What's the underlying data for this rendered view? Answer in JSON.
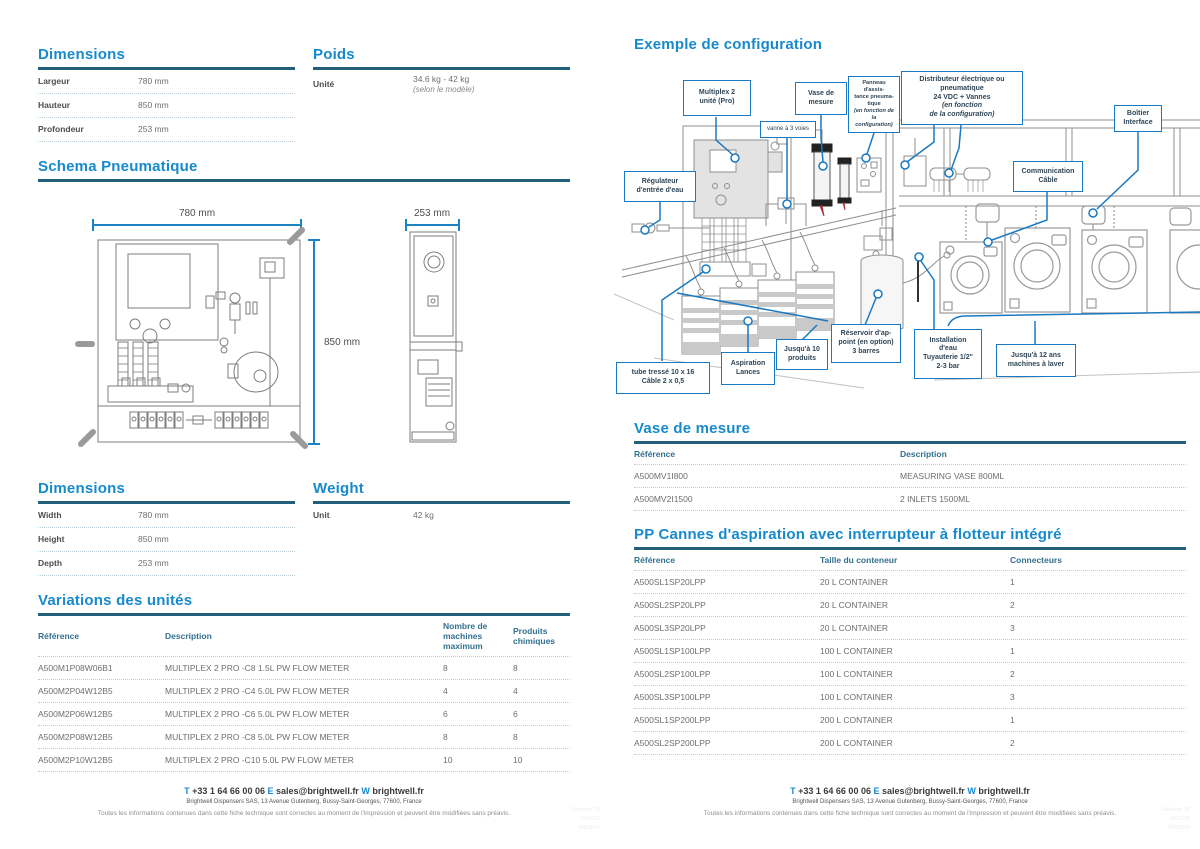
{
  "page_left": {
    "dimensions_fr": {
      "title": "Dimensions",
      "rows": [
        {
          "label": "Largeur",
          "value": "780 mm"
        },
        {
          "label": "Hauteur",
          "value": "850 mm"
        },
        {
          "label": "Profondeur",
          "value": "253 mm"
        }
      ]
    },
    "poids": {
      "title": "Poids",
      "label": "Unité",
      "value": "34.6 kg - 42 kg",
      "note": "(selon le modèle)"
    },
    "schema": {
      "title": "Schema Pneumatique",
      "width_dim": "780 mm",
      "height_dim": "850 mm",
      "depth_dim": "253 mm"
    },
    "dimensions_en": {
      "title": "Dimensions",
      "rows": [
        {
          "label": "Width",
          "value": "780 mm"
        },
        {
          "label": "Height",
          "value": "850 mm"
        },
        {
          "label": "Depth",
          "value": "253 mm"
        }
      ]
    },
    "weight": {
      "title": "Weight",
      "label": "Unit",
      "value": "42 kg"
    },
    "variations": {
      "title": "Variations des unités",
      "headers": {
        "ref": "Référence",
        "desc": "Description",
        "machines": "Nombre de\nmachines\nmaximum",
        "produits": "Produits\nchimiques"
      },
      "rows": [
        {
          "ref": "A500M1P08W06B1",
          "desc": "MULTIPLEX 2 PRO -C8 1.5L PW FLOW METER",
          "machines": "8",
          "produits": "8"
        },
        {
          "ref": "A500M2P04W12B5",
          "desc": "MULTIPLEX 2 PRO -C4 5.0L PW FLOW METER",
          "machines": "4",
          "produits": "4"
        },
        {
          "ref": "A500M2P06W12B5",
          "desc": "MULTIPLEX 2 PRO -C6 5.0L PW FLOW METER",
          "machines": "6",
          "produits": "6"
        },
        {
          "ref": "A500M2P08W12B5",
          "desc": "MULTIPLEX 2 PRO -C8 5.0L PW FLOW METER",
          "machines": "8",
          "produits": "8"
        },
        {
          "ref": "A500M2P10W12B5",
          "desc": "MULTIPLEX 2 PRO -C10 5.0L PW FLOW METER",
          "machines": "10",
          "produits": "10"
        }
      ]
    }
  },
  "page_right": {
    "config": {
      "title": "Exemple de configuration",
      "labels": {
        "multiplex": "Multiplex 2\nunité (Pro)",
        "vanne": "vanne à 3 voies",
        "vase": "Vase de\nmesure",
        "panneau": "Panneau d'assis-\ntance pneuma-\ntique",
        "panneau_note": "(en fonction de la\nconfiguration)",
        "distributeur": "Distributeur électrique ou\npneumatique\n24 VDC + Vannes",
        "distributeur_note": "(en fonction\nde la configuration)",
        "boitier": "Boîtier\nInterface",
        "regulateur": "Régulateur\nd'entrée d'eau",
        "communication": "Communication\nCâble",
        "tube": "tube tressé 10 x 16\nCâble 2 x 0,5",
        "aspiration": "Aspiration\nLances",
        "jusqua10": "Jusqu'à 10\nproduits",
        "reservoir": "Réservoir d'ap-\npoint (en option)\n3 barres",
        "installation": "Installation\nd'eau\nTuyauterie 1/2\"\n2-3 bar",
        "jusqua12": "Jusqu'à 12 ans\nmachines à laver"
      }
    },
    "vase": {
      "title": "Vase de mesure",
      "headers": {
        "ref": "Référence",
        "desc": "Description"
      },
      "rows": [
        {
          "ref": "A500MV1I800",
          "desc": "MEASURING VASE 800ML"
        },
        {
          "ref": "A500MV2I1500",
          "desc": "2 INLETS 1500ML"
        }
      ]
    },
    "pp": {
      "title": "PP Cannes d'aspiration avec interrupteur à flotteur intégré",
      "headers": {
        "ref": "Référence",
        "taille": "Taille du conteneur",
        "conn": "Connecteurs"
      },
      "rows": [
        {
          "ref": "A500SL1SP20LPP",
          "taille": "20 L CONTAINER",
          "conn": "1"
        },
        {
          "ref": "A500SL2SP20LPP",
          "taille": "20 L CONTAINER",
          "conn": "2"
        },
        {
          "ref": "A500SL3SP20LPP",
          "taille": "20 L CONTAINER",
          "conn": "3"
        },
        {
          "ref": "A500SL1SP100LPP",
          "taille": "100  L CONTAINER",
          "conn": "1"
        },
        {
          "ref": "A500SL2SP100LPP",
          "taille": "100  L CONTAINER",
          "conn": "2"
        },
        {
          "ref": "A500SL3SP100LPP",
          "taille": "100  L CONTAINER",
          "conn": "3"
        },
        {
          "ref": "A500SL1SP200LPP",
          "taille": "200 L CONTAINER",
          "conn": "1"
        },
        {
          "ref": "A500SL2SP200LPP",
          "taille": "200 L CONTAINER",
          "conn": "2"
        }
      ]
    }
  },
  "footer": {
    "t": "T",
    "phone": "+33 1 64 66 00 06",
    "e": "E",
    "email": "sales@brightwell.fr",
    "w": "W",
    "web": "brightwell.fr",
    "address": "Brightwell Dispensers SAS, 13 Avenue Gutenberg, Bussy-Saint-Georges, 77600, France",
    "disclaimer": "Toutes les informations contenues dans cette fiche technique sont correctes au moment de l'impression et peuvent être modifiées sans préavis.",
    "revision": "Revision 15\nG02025\nBW2814"
  }
}
